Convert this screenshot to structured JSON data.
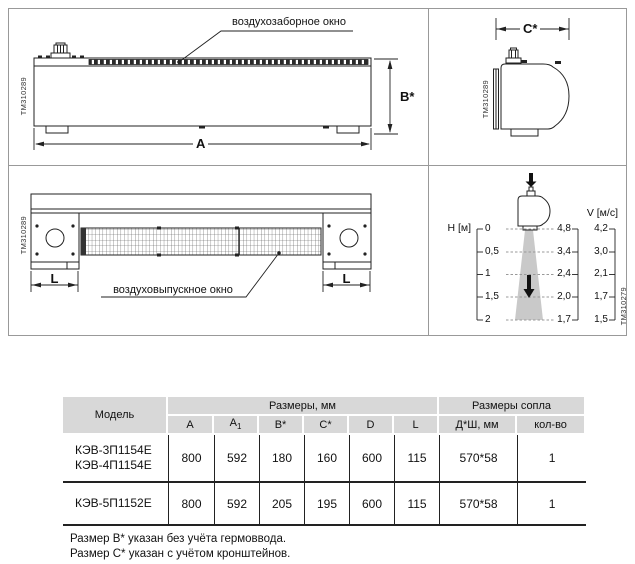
{
  "colors": {
    "line": "#222222",
    "frame": "#999999",
    "table_header_bg": "#d8d8d8",
    "cone_fill": "#c9c9c9"
  },
  "front_view": {
    "intake_window_label": "воздухозаборное окно",
    "dim_length": "A",
    "dim_height": "B*",
    "tm_code": "ТМ310289"
  },
  "side_view": {
    "dim_depth": "C*",
    "tm_code": "ТМ310289"
  },
  "bottom_view": {
    "outlet_window_label": "воздуховыпускное окно",
    "dim_bracket_left": "L",
    "dim_bracket_right": "L",
    "tm_code": "ТМ310289"
  },
  "airflow_chart": {
    "type": "table",
    "h_axis_label": "H [м]",
    "v_axis_label": "V [м/с]",
    "tm_code": "ТМ310279",
    "rows": [
      {
        "h": "0",
        "v_center": "4,8",
        "v_edge": "4,2"
      },
      {
        "h": "0,5",
        "v_center": "3,4",
        "v_edge": "3,0"
      },
      {
        "h": "1",
        "v_center": "2,4",
        "v_edge": "2,1"
      },
      {
        "h": "1,5",
        "v_center": "2,0",
        "v_edge": "1,7"
      },
      {
        "h": "2",
        "v_center": "1,7",
        "v_edge": "1,5"
      }
    ]
  },
  "table": {
    "headers": {
      "model": "Модель",
      "dimensions_group": "Размеры, мм",
      "nozzle_group": "Размеры сопла",
      "col_a": "A",
      "col_a1_base": "A",
      "col_a1_sub": "1",
      "col_b": "B*",
      "col_c": "C*",
      "col_d": "D",
      "col_l": "L",
      "col_nozzle_size": "Д*Ш, мм",
      "col_nozzle_count": "кол-во"
    },
    "rows": [
      {
        "models": [
          "КЭВ-3П1154Е",
          "КЭВ-4П1154Е"
        ],
        "a": "800",
        "a1": "592",
        "b": "180",
        "c": "160",
        "d": "600",
        "l": "115",
        "nozzle": "570*58",
        "count": "1"
      },
      {
        "models": [
          "КЭВ-5П1152Е"
        ],
        "a": "800",
        "a1": "592",
        "b": "205",
        "c": "195",
        "d": "600",
        "l": "115",
        "nozzle": "570*58",
        "count": "1"
      }
    ]
  },
  "footnotes": [
    "Размер B* указан без учёта гермоввода.",
    "Размер C* указан с учётом кронштейнов."
  ]
}
